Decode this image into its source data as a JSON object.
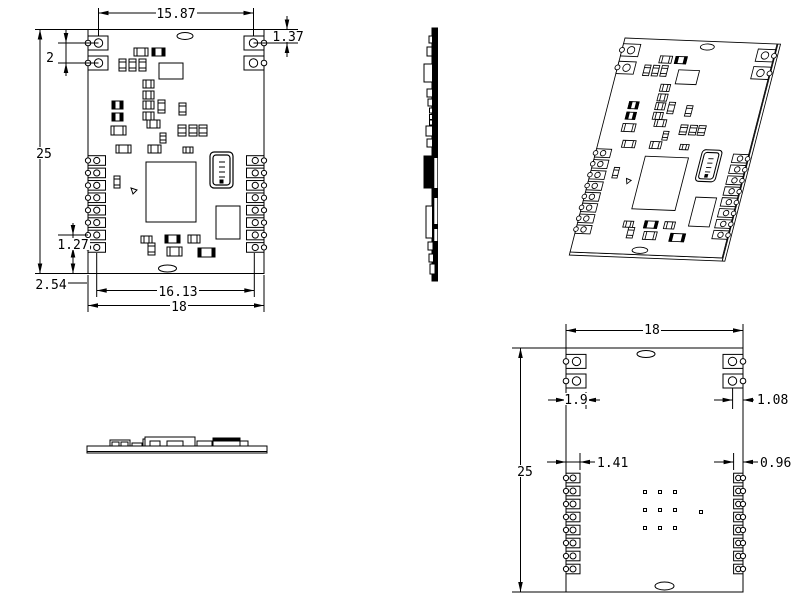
{
  "drawing": {
    "type": "pcb-module-multiview-technical-drawing",
    "line_color": "#000000",
    "background_color": "#ffffff",
    "views": {
      "top": {
        "label": "top-view",
        "dims": {
          "hole_span": "15.87",
          "hole_top_offset": "1.37",
          "hole_pitch": "2",
          "board_height": "25",
          "pad_pitch": "1.27",
          "pad_bottom_offset": "2.54",
          "pad_span": "16.13",
          "board_width": "18"
        }
      },
      "bottom": {
        "label": "bottom-view",
        "dims": {
          "board_width": "18",
          "tab_width": "1.9",
          "hole_edge_offset": "1.08",
          "board_height": "25",
          "pad_width_left": "1.41",
          "pad_width_right": "0.96"
        }
      }
    }
  }
}
